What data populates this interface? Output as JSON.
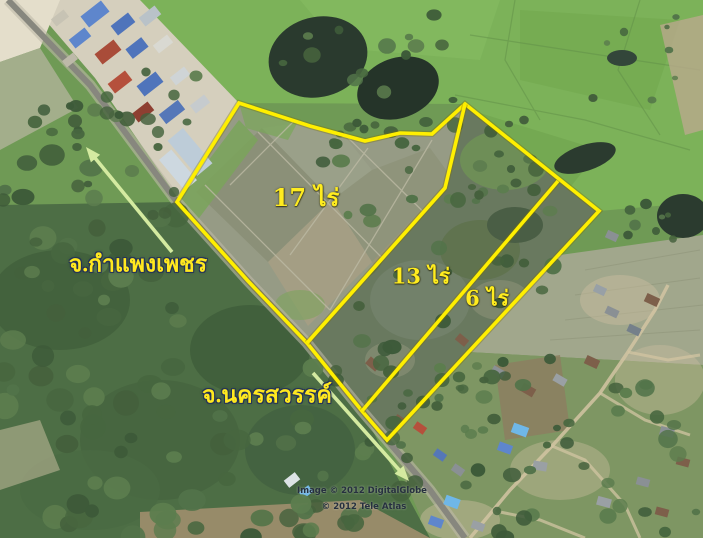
{
  "map": {
    "attribution": {
      "line1": "Image © 2012 DigitalGlobe",
      "line2": "© 2012 Tele Atlas"
    },
    "labels": {
      "area_17": {
        "text": "17 ไร่",
        "x": 306,
        "y": 198,
        "size": 24
      },
      "area_13": {
        "text": "13 ไร่",
        "x": 421,
        "y": 276,
        "size": 21
      },
      "area_6": {
        "text": "6 ไร่",
        "x": 487,
        "y": 298,
        "size": 21
      },
      "province_north": {
        "text": "จ.กำแพงเพชร",
        "x": 138,
        "y": 264,
        "size": 23
      },
      "province_south": {
        "text": "จ.นครสวรรค์",
        "x": 267,
        "y": 395,
        "size": 23
      },
      "attr1": {
        "text": "Image © 2012 DigitalGlobe",
        "x": 362,
        "y": 491,
        "size": 8.5
      },
      "attr2": {
        "text": "© 2012 Tele Atlas",
        "x": 364,
        "y": 507,
        "size": 8.5
      }
    },
    "boundary_color": "#ffef00",
    "boundary_shadow": "#7a7000",
    "arrow_color": "#d4eaa0",
    "boundaries": [
      {
        "id": "outer-property",
        "closed": true,
        "points": [
          [
            177,
            202
          ],
          [
            239,
            103
          ],
          [
            310,
            126
          ],
          [
            365,
            141
          ],
          [
            400,
            133
          ],
          [
            432,
            134
          ],
          [
            465,
            104
          ],
          [
            599,
            211
          ],
          [
            387,
            440
          ],
          [
            362,
            411
          ],
          [
            307,
            343
          ],
          [
            248,
            281
          ]
        ]
      },
      {
        "id": "divider-17-13",
        "closed": false,
        "points": [
          [
            465,
            104
          ],
          [
            445,
            188
          ],
          [
            307,
            343
          ]
        ]
      },
      {
        "id": "divider-13-6",
        "closed": false,
        "points": [
          [
            558,
            181
          ],
          [
            362,
            411
          ]
        ]
      }
    ],
    "arrows": [
      {
        "id": "arrow-to-kamphaengphet",
        "from": [
          172,
          252
        ],
        "to": [
          86,
          147
        ]
      },
      {
        "id": "arrow-to-nakhonsawan",
        "from": [
          313,
          373
        ],
        "to": [
          409,
          481
        ]
      }
    ]
  }
}
